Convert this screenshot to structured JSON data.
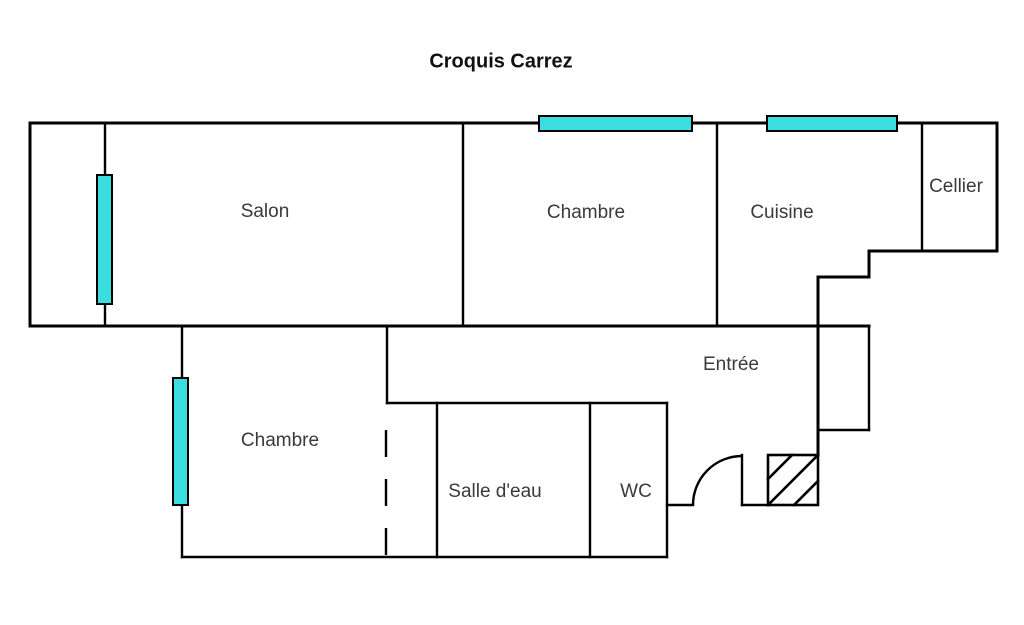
{
  "title": "Croquis Carrez",
  "rooms": {
    "salon": "Salon",
    "chambre_top": "Chambre",
    "cuisine": "Cuisine",
    "cellier": "Cellier",
    "entree": "Entrée",
    "chambre_bottom": "Chambre",
    "salle_eau": "Salle d'eau",
    "wc": "WC"
  },
  "windows": {
    "color": "#3ADEDE"
  }
}
